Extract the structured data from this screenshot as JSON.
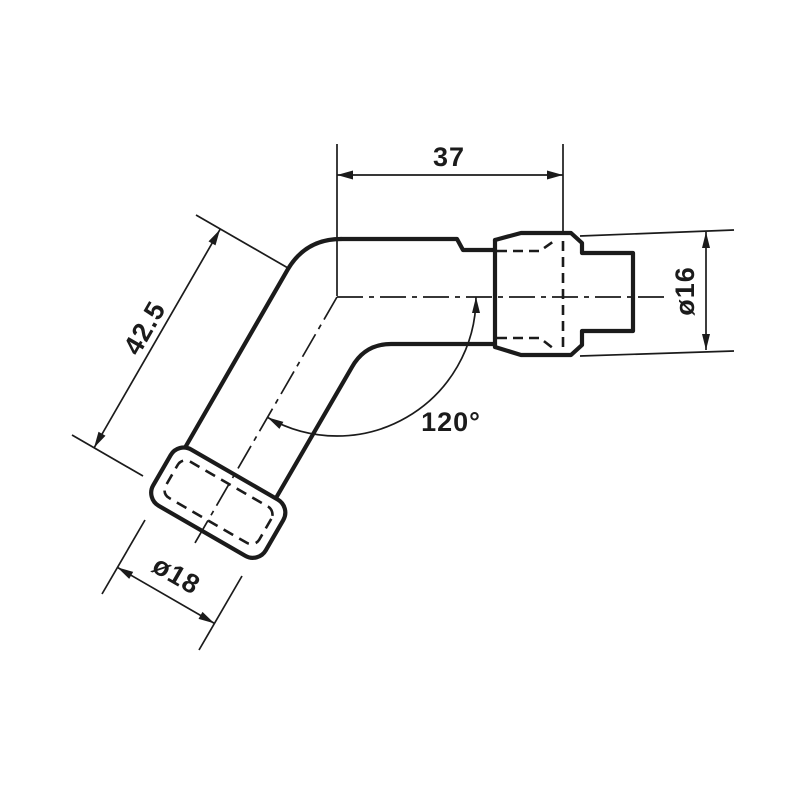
{
  "drawing": {
    "description": "spark plug cap technical drawing",
    "colors": {
      "ink": "#1b1b1b",
      "background": "#ffffff"
    },
    "labels": {
      "top_width": "37",
      "side_length": "42.5",
      "bend_angle": "120°",
      "terminal_diameter": "ø16",
      "boot_diameter": "ø18"
    }
  }
}
